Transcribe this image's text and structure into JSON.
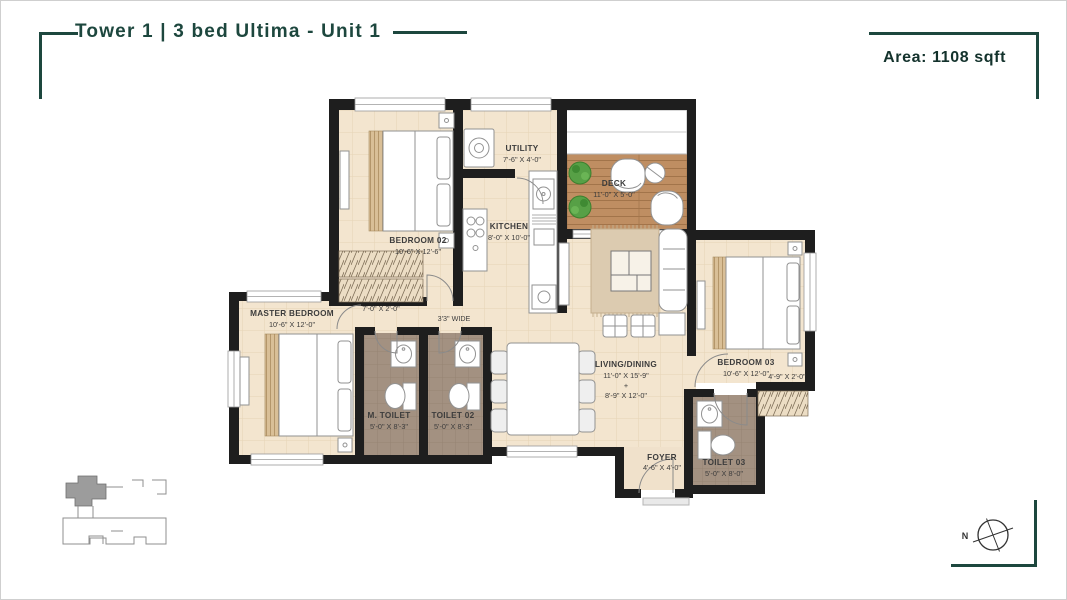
{
  "header": {
    "title": "Tower 1 | 3 bed Ultima - Unit 1",
    "area": "Area: 1108 sqft"
  },
  "compass": {
    "north": "N"
  },
  "rooms": [
    {
      "name": "BEDROOM 02",
      "dims": "10'-6\" X 12'-6\""
    },
    {
      "name": "UTILITY",
      "dims": "7'-6\" X 4'-0\""
    },
    {
      "name": "KITCHEN",
      "dims": "8'-0\" X 10'-0\""
    },
    {
      "name": "DECK",
      "dims": "11'-0\" X 5'-0\""
    },
    {
      "name": "MASTER BEDROOM",
      "dims": "10'-6\" X 12'-0\""
    },
    {
      "name": "M. TOILET",
      "dims": "5'-0\" X 8'-3\""
    },
    {
      "name": "TOILET 02",
      "dims": "5'-0\" X 8'-3\""
    },
    {
      "name": "LIVING/DINING",
      "dims1": "11'-0\" X 15'-9\"",
      "plus": "+",
      "dims2": "8'-9\" X 12'-0\""
    },
    {
      "name": "BEDROOM 03",
      "dims": "10'-6\" X 12'-0\""
    },
    {
      "name": "TOILET 03",
      "dims": "5'-0\" X 8'-0\""
    },
    {
      "name": "FOYER",
      "dims": "4'-6\" X 4'-0\""
    }
  ],
  "annotations": {
    "wardrobe_ledge": "7'-0\" X 2'-0\"",
    "bedroom03_ledge": "4'-9\" X 2'-0\"",
    "passage": "3'3\" WIDE"
  },
  "colors": {
    "accent": "#1d473e",
    "wall": "#1e1e1e",
    "floor": "#f3e5cf",
    "deck_wood": "#bf8e62",
    "toilet_floor": "#a39181"
  }
}
